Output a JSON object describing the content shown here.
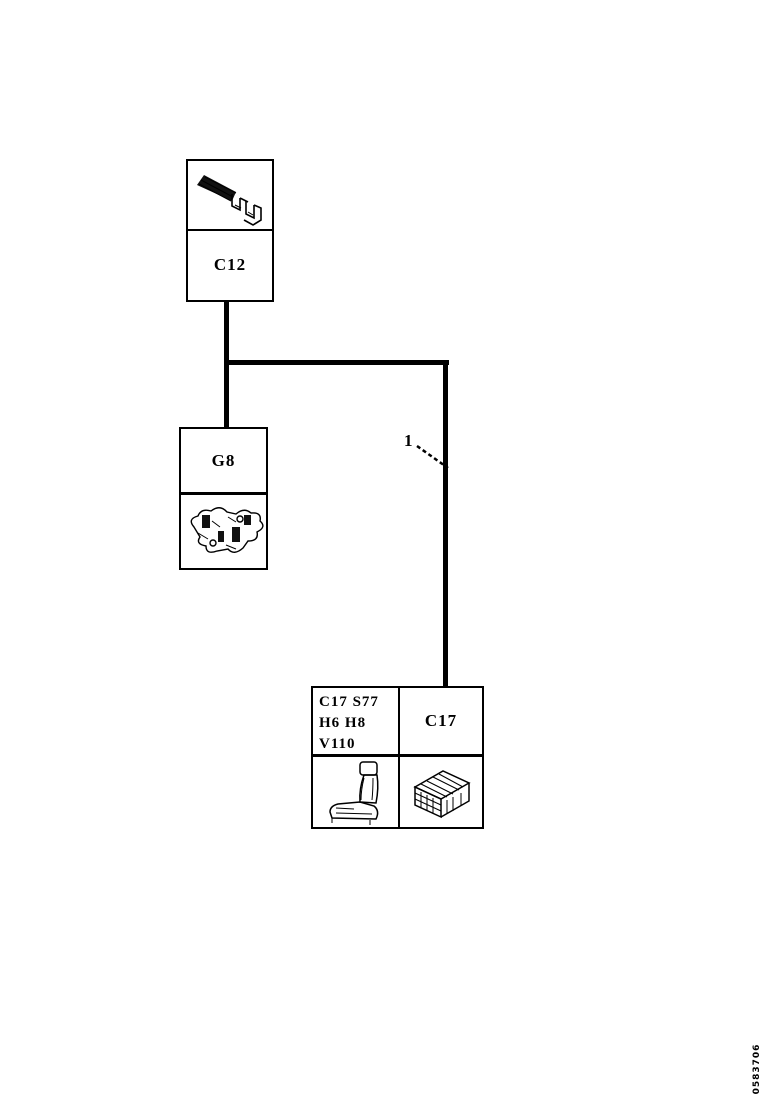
{
  "page": {
    "background": "#ffffff",
    "ink": "#000000",
    "doc_number": "0583706"
  },
  "diagram": {
    "type": "wiring-harness-diagram",
    "callout": {
      "number": "1"
    },
    "boxes": {
      "c12": {
        "label": "C12",
        "image": "terminal-icon"
      },
      "g8": {
        "label": "G8",
        "image": "harness-bracket-icon"
      },
      "c17_group": {
        "codes": [
          "C17 S77",
          "H6 H8",
          "V110"
        ],
        "label": "C17",
        "images": [
          "seat-icon",
          "connector-icon"
        ]
      }
    }
  }
}
